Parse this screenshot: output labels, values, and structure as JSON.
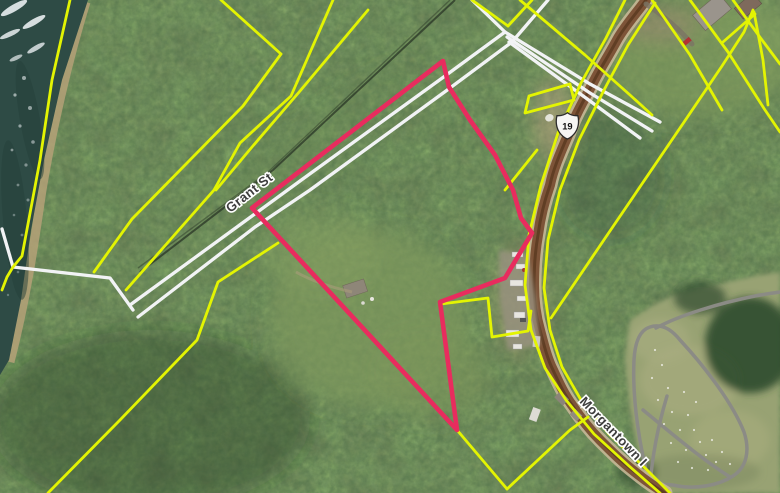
{
  "map": {
    "labels": {
      "street_1": "Grant St",
      "street_2": "Morgantown I",
      "route_shield": "19"
    },
    "icons": [
      {
        "name": "us-route-shield-icon",
        "label": "19"
      }
    ],
    "colors": {
      "parcel_highlight": "#e82c5e",
      "parcel_line": "#e3f402",
      "road_casing_line": "#f2f3f5",
      "road_surface": "#7d5438",
      "water": "#2e4b45",
      "forest": "#33512f",
      "clearing_grass": "#7f9a5e",
      "cemetery_grass": "#98a273"
    }
  }
}
